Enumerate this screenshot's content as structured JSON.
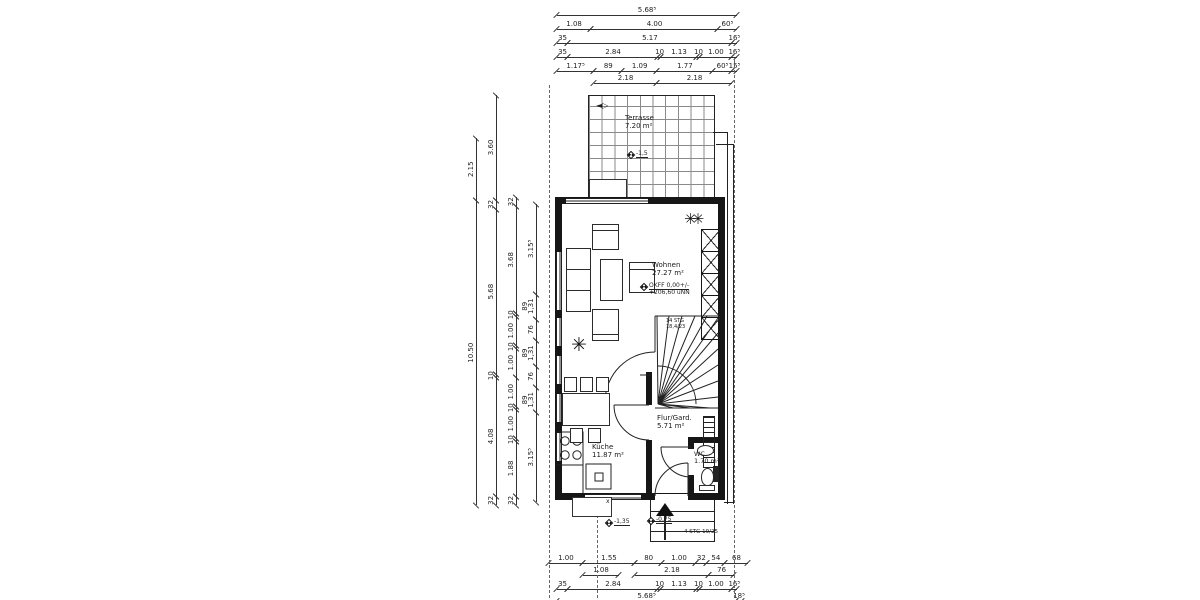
{
  "rooms": {
    "terrasse": {
      "name": "Terrasse",
      "area": "7.20 m²"
    },
    "wohnen": {
      "name": "Wohnen",
      "area": "27.27 m²"
    },
    "kueche": {
      "name": "Küche",
      "area": "11.87 m²"
    },
    "flur": {
      "name": "Flur/Gard.",
      "area": "5.71 m²"
    },
    "wc": {
      "name": "WC",
      "area": "1.70 m²"
    }
  },
  "stairs": {
    "main_note_1": "14 STG",
    "main_note_2": "18,4/23",
    "entry_note": "4 STG 19/25"
  },
  "levels": {
    "terrace": "-1,5",
    "okff_line1": "OKFF 0,00+/-",
    "okff_line2": "+206,60 üNN",
    "garden": "-1,35",
    "entry": "-0,75"
  },
  "symbols": {
    "slider": "◄▷",
    "porch_mark": "x"
  },
  "dim_chains": {
    "top_total": [
      {
        "t": "5.68⁵",
        "w": 5.685
      }
    ],
    "top_r2": [
      {
        "t": "1.08",
        "w": 1.08
      },
      {
        "t": "4.00",
        "w": 4
      },
      {
        "t": "60⁵",
        "w": 0.605
      }
    ],
    "top_r3": [
      {
        "t": "35",
        "w": 0.35
      },
      {
        "t": "5.17",
        "w": 5.17
      },
      {
        "t": "16⁵",
        "w": 0.165
      }
    ],
    "top_r4": [
      {
        "t": "35",
        "w": 0.35
      },
      {
        "t": "2.84",
        "w": 2.84
      },
      {
        "t": "10",
        "w": 0.1
      },
      {
        "t": "1.13",
        "w": 1.13
      },
      {
        "t": "10",
        "w": 0.1
      },
      {
        "t": "1.00",
        "w": 1
      },
      {
        "t": "16⁵",
        "w": 0.165
      }
    ],
    "top_r5": [
      {
        "t": "1.17⁵",
        "w": 1.175
      },
      {
        "t": "89",
        "w": 0.89
      },
      {
        "t": "1.09",
        "w": 1.09
      },
      {
        "t": "1.77",
        "w": 1.77
      },
      {
        "t": "60⁵",
        "w": 0.605
      },
      {
        "t": "15⁵",
        "w": 0.155
      }
    ],
    "top_r6": [
      {
        "t": "",
        "w": 1.175
      },
      {
        "t": "2.18",
        "w": 1.98
      },
      {
        "t": "2.18",
        "w": 2.375
      },
      {
        "t": "",
        "w": 0.155
      }
    ],
    "bot_r1": [
      {
        "t": "1.00",
        "w": 1
      },
      {
        "t": "1.55",
        "w": 1.55
      },
      {
        "t": "80",
        "w": 0.8
      },
      {
        "t": "1.00",
        "w": 1
      },
      {
        "t": "32",
        "w": 0.32
      },
      {
        "t": "54",
        "w": 0.54
      },
      {
        "t": "68",
        "w": 0.68
      }
    ],
    "bot_r2": [
      {
        "t": "",
        "w": 1
      },
      {
        "t": "1.08",
        "w": 1.08
      },
      {
        "t": "",
        "w": 0.47
      },
      {
        "t": "2.18",
        "w": 2.18
      },
      {
        "t": "76",
        "w": 0.76
      },
      {
        "t": "",
        "w": 0.4
      }
    ],
    "bot_r3": [
      {
        "t": "35",
        "w": 0.35
      },
      {
        "t": "2.84",
        "w": 2.84
      },
      {
        "t": "10",
        "w": 0.1
      },
      {
        "t": "1.13",
        "w": 1.13
      },
      {
        "t": "10",
        "w": 0.1
      },
      {
        "t": "1.00",
        "w": 1
      },
      {
        "t": "16⁵",
        "w": 0.165
      }
    ],
    "bot_r4": [
      {
        "t": "5.68⁵",
        "w": 5.685
      },
      {
        "t": "18⁵",
        "w": 0.185
      }
    ],
    "left_1": [
      {
        "t": "10.50",
        "w": 10.5
      },
      {
        "t": "2.15",
        "w": 2.15
      }
    ],
    "left_2": [
      {
        "t": "32",
        "w": 0.32
      },
      {
        "t": "4.08",
        "w": 4.08
      },
      {
        "t": "10",
        "w": 0.1
      },
      {
        "t": "5.68",
        "w": 5.68
      },
      {
        "t": "32",
        "w": 0.32
      },
      {
        "t": "3.60",
        "w": 3.6
      }
    ],
    "left_3": [
      {
        "t": "32",
        "w": 0.32
      },
      {
        "t": "1.88",
        "w": 1.88
      },
      {
        "t": "10",
        "w": 0.1
      },
      {
        "t": "1.00",
        "w": 1
      },
      {
        "t": "10",
        "w": 0.1
      },
      {
        "t": "1.00",
        "w": 1
      },
      {
        "t": "1.00",
        "w": 1
      },
      {
        "t": "10",
        "w": 0.1
      },
      {
        "t": "1.00",
        "w": 1
      },
      {
        "t": "10",
        "w": 0.1
      },
      {
        "t": "3.68",
        "w": 3.68
      },
      {
        "t": "32",
        "w": 0.32
      }
    ],
    "left_4": [
      {
        "t": "3.15⁵",
        "w": 3.155
      },
      {
        "t": "89\n1,31",
        "w": 0.89
      },
      {
        "t": "76",
        "w": 0.76
      },
      {
        "t": "89\n1,31",
        "w": 0.89
      },
      {
        "t": "76",
        "w": 0.76
      },
      {
        "t": "89\n1,31",
        "w": 0.89
      },
      {
        "t": "3.15⁵",
        "w": 3.155
      }
    ],
    "entry_75": [
      {
        "t": "75",
        "w": 1
      }
    ]
  }
}
